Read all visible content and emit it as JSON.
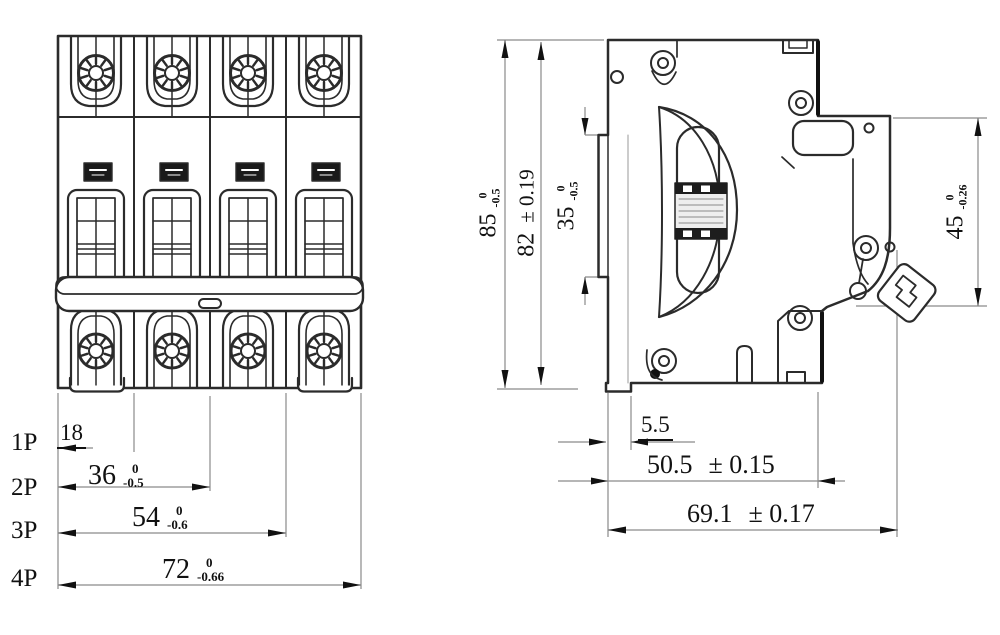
{
  "drawing_title": "circuit-breaker-outline-dimensions",
  "colors": {
    "background": "#ffffff",
    "line": "#2b2b2b",
    "dimension_line": "#8a8a8a",
    "text": "#111111"
  },
  "pole_labels": [
    "1P",
    "2P",
    "3P",
    "4P"
  ],
  "dims": {
    "w18": {
      "value": "18"
    },
    "w36": {
      "value": "36",
      "tol_top": "0",
      "tol_bot": "-0.5"
    },
    "w54": {
      "value": "54",
      "tol_top": "0",
      "tol_bot": "-0.6"
    },
    "w72": {
      "value": "72",
      "tol_top": "0",
      "tol_bot": "-0.66"
    },
    "h85": {
      "value": "85",
      "tol_top": "0",
      "tol_bot": "-0.5"
    },
    "h82": {
      "value": "82",
      "tol": "± 0.19"
    },
    "h35": {
      "value": "35",
      "tol_top": "0",
      "tol_bot": "-0.5"
    },
    "h45": {
      "value": "45",
      "tol_top": "0",
      "tol_bot": "-0.26"
    },
    "d55": {
      "value": "5.5"
    },
    "d505": {
      "value": "50.5",
      "tol": "± 0.15"
    },
    "d691": {
      "value": "69.1",
      "tol": "± 0.17"
    }
  }
}
